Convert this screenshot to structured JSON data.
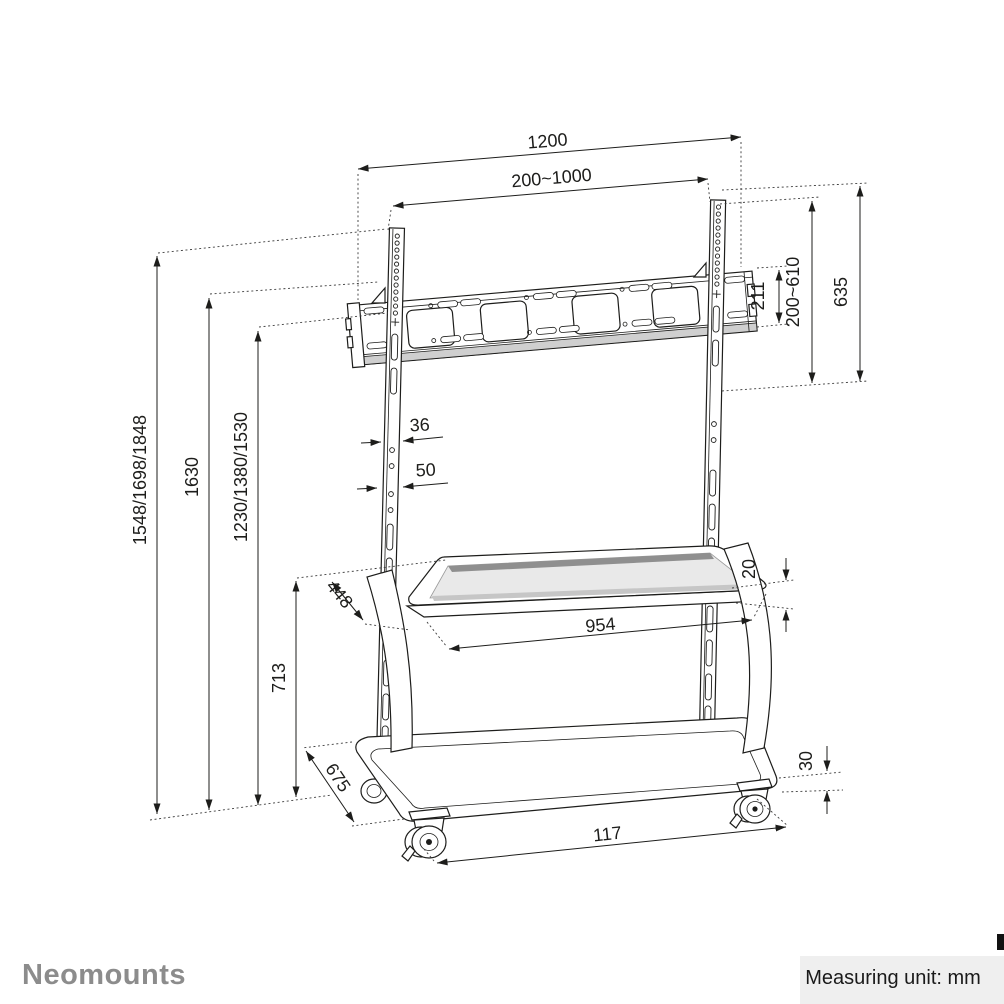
{
  "footer": {
    "brand": "Neomounts",
    "measuring_unit": "Measuring unit: mm"
  },
  "colors": {
    "line": "#1d1d1b",
    "dotted_extension": "#3c3c3c",
    "brand_gray": "#8c8c8c",
    "footer_badge_bg": "#efefef",
    "shelf_surface": "#e9e9e9",
    "shelf_back_shade": "#8f8f8f",
    "bar_lower_shade": "#cfcfcf"
  },
  "drawing": {
    "subject": "mobile TV floor stand trolley with mount bar, shelf, base and casters"
  },
  "dims": {
    "total_width": {
      "label": "1200"
    },
    "vesa_width_range": {
      "label": "200~1000"
    },
    "bracket_plate_height": {
      "label": "211"
    },
    "vesa_height_range": {
      "label": "200~610"
    },
    "bracket_total_height": {
      "label": "635"
    },
    "column_front_depth": {
      "label": "36"
    },
    "column_side_depth": {
      "label": "50"
    },
    "total_height_options": {
      "label": "1548/1698/1848"
    },
    "height_to_bar_top": {
      "label": "1630"
    },
    "height_to_bar_bottom": {
      "label": "1230/1380/1530"
    },
    "shelf_height": {
      "label": "713"
    },
    "shelf_depth": {
      "label": "448"
    },
    "shelf_thickness": {
      "label": "20"
    },
    "shelf_width": {
      "label": "954"
    },
    "base_depth": {
      "label": "675"
    },
    "base_tube_height": {
      "label": "30"
    },
    "base_width": {
      "label": "117"
    }
  }
}
